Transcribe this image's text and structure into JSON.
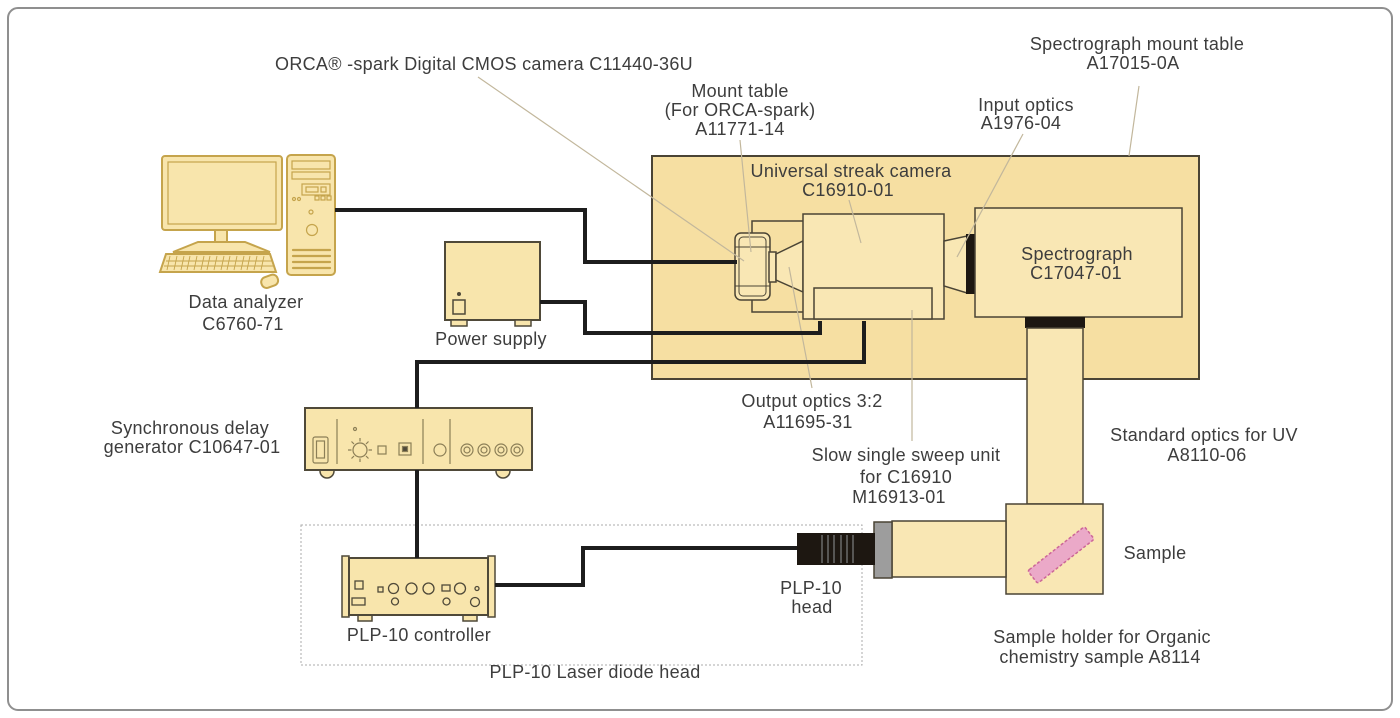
{
  "labels": {
    "orca_camera": "ORCA® -spark Digital CMOS camera C11440-36U",
    "mount_table": [
      "Mount table",
      "(For ORCA-spark)",
      "A11771-14"
    ],
    "input_optics": [
      "Input optics",
      "A1976-04"
    ],
    "spectrograph_mount_table": [
      "Spectrograph mount table",
      "A17015-0A"
    ],
    "streak_camera": [
      "Universal streak camera",
      "C16910-01"
    ],
    "spectrograph": [
      "Spectrograph",
      "C17047-01"
    ],
    "data_analyzer": [
      "Data analyzer",
      "C6760-71"
    ],
    "power_supply": "Power supply",
    "sync_delay_generator": [
      "Synchronous delay",
      "generator C10647-01"
    ],
    "output_optics": [
      "Output optics 3:2",
      "A11695-31"
    ],
    "slow_sweep_unit": [
      "Slow single sweep unit",
      "for C16910",
      "M16913-01"
    ],
    "standard_optics_uv": [
      "Standard optics for UV",
      "A8110-06"
    ],
    "sample": "Sample",
    "sample_holder": [
      "Sample holder for Organic",
      "chemistry sample A8114"
    ],
    "plp10_head": [
      "PLP-10",
      "head"
    ],
    "plp10_controller": "PLP-10 controller",
    "plp10_laser_diode_head": "PLP-10 Laser diode head"
  },
  "colors": {
    "device_fill": "#f8e5ac",
    "mount_table_fill": "#f6dfa2",
    "unit_fill": "#f9e7b4",
    "gold_stroke": "#c5a44c",
    "dark_stroke": "#4a4435",
    "cable": "#1d1d1d",
    "leader_line": "#c2b79c",
    "black_part": "#1d1711",
    "collar_gray": "#9d9d9d",
    "sample_fill": "#eba9c8",
    "sample_stroke": "#cc6697",
    "text": "#3d3d3d",
    "frame": "#8f8f8f"
  }
}
